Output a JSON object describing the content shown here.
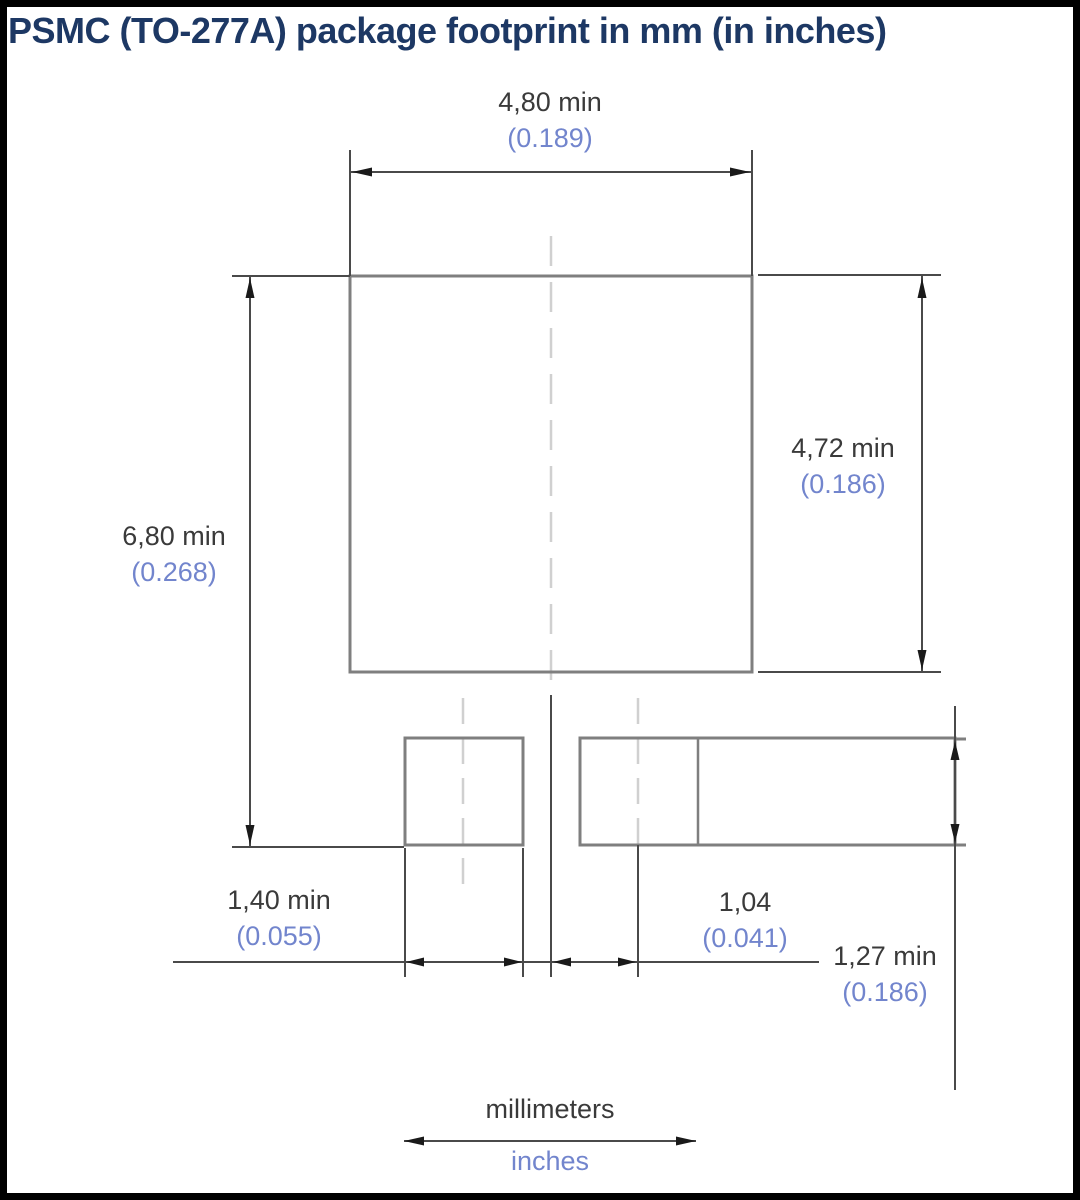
{
  "title": "PSMC (TO-277A) package footprint in mm (in inches)",
  "dimensions": {
    "pad_width": {
      "mm": "4,80 min",
      "in": "(0.189)"
    },
    "pad_height": {
      "mm": "4,72 min",
      "in": "(0.186)"
    },
    "overall_height": {
      "mm": "6,80 min",
      "in": "(0.268)"
    },
    "lead_width": {
      "mm": "1,40 min",
      "in": "(0.055)"
    },
    "lead_offset": {
      "mm": "1,04",
      "in": "(0.041)"
    },
    "lead_length": {
      "mm": "1,27 min",
      "in": "(0.186)"
    }
  },
  "legend": {
    "top": "millimeters",
    "bottom": "inches"
  },
  "colors": {
    "title_text": "#1d3864",
    "mm_text": "#3a3a3a",
    "inch_text": "#7285cd",
    "object_line": "#7f7f7f",
    "dimension_line": "#4a4a4a",
    "centerline": "#d0d0d0",
    "border": "#000000",
    "background": "#ffffff"
  }
}
